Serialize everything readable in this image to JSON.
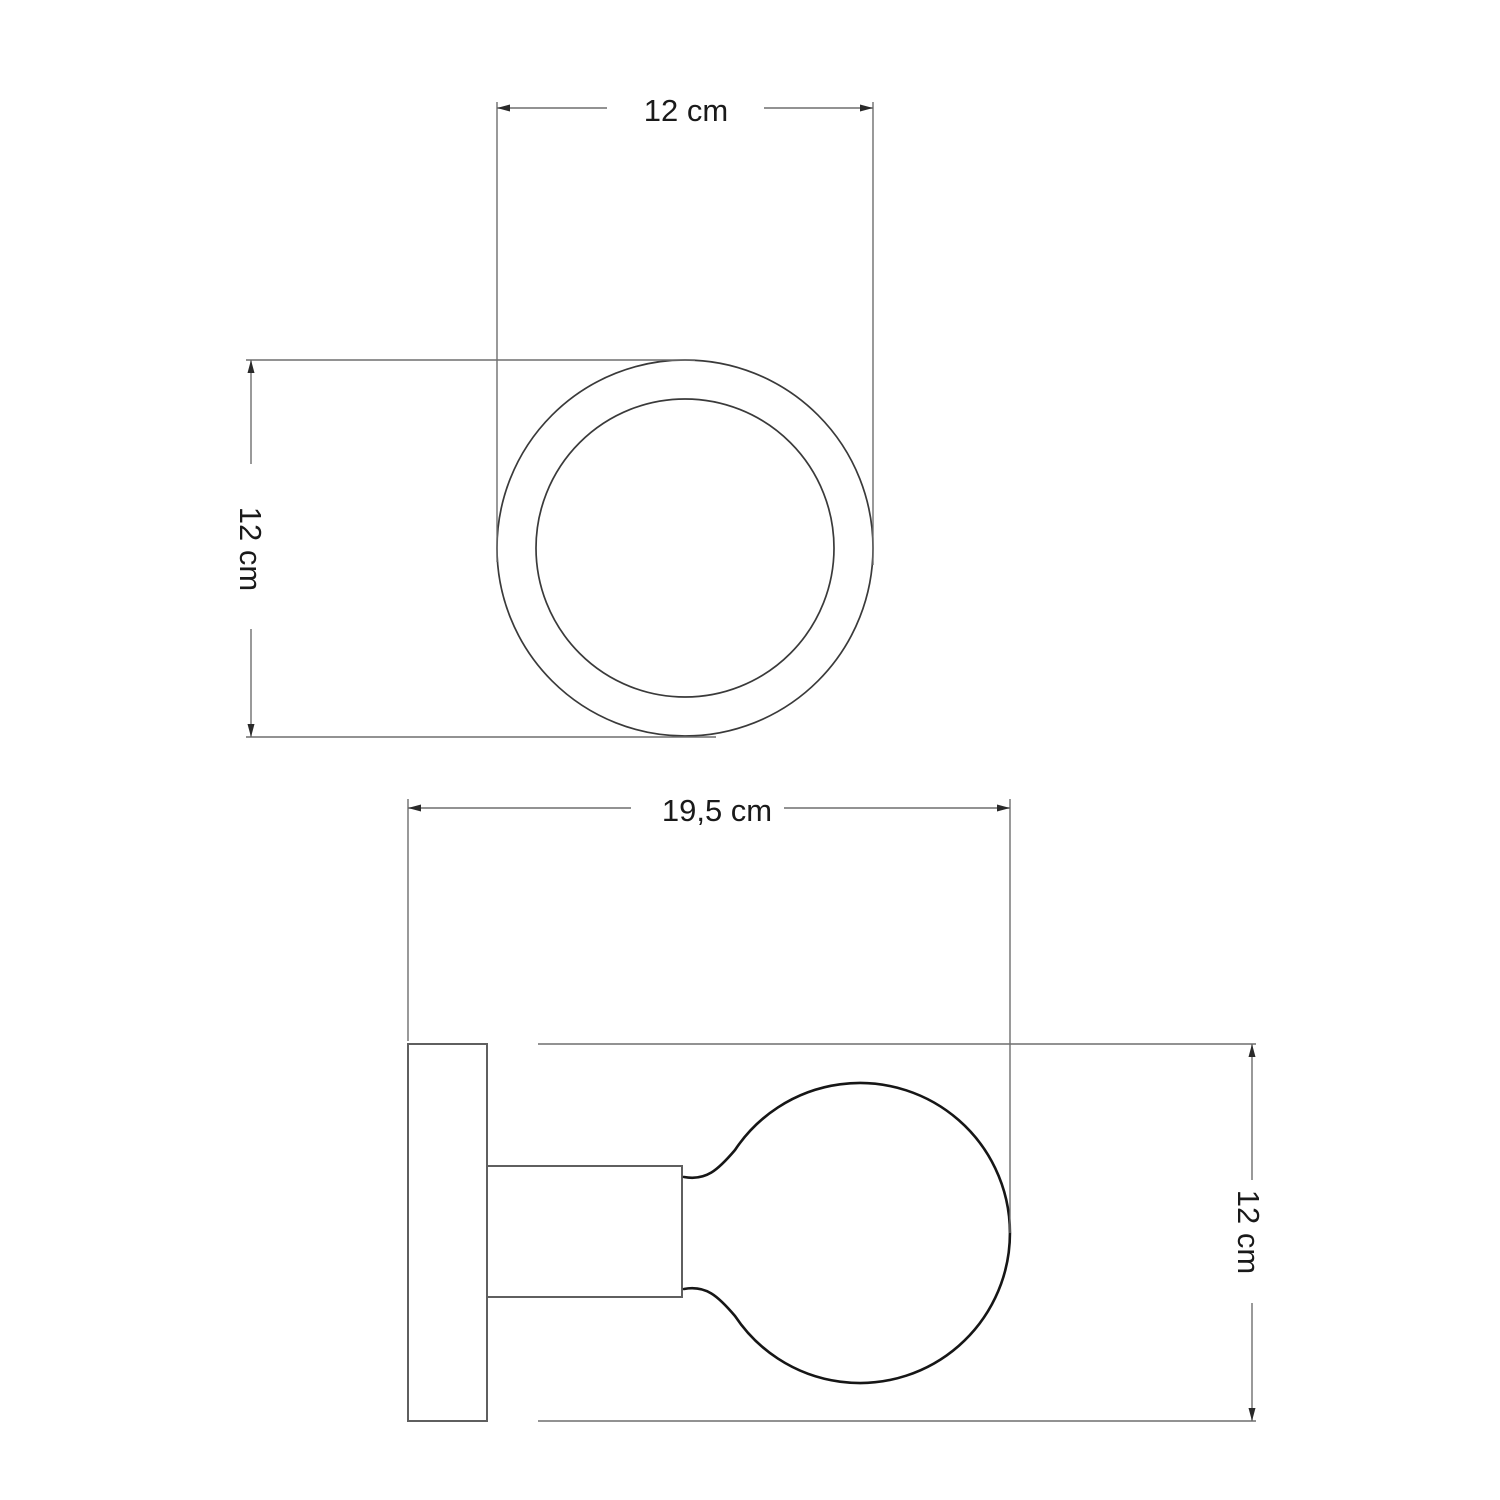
{
  "drawing": {
    "type": "technical-dimension-drawing",
    "subject": "wall lamp with round backplate, lamp holder and globe bulb",
    "unit": "cm",
    "views": {
      "top": {
        "name": "front view (round plate)",
        "width_dim": "12 cm",
        "height_dim": "12 cm",
        "width_value": 12,
        "height_value": 12
      },
      "side": {
        "name": "side view (plate, holder, bulb)",
        "width_dim": "19,5 cm",
        "height_dim": "12 cm",
        "width_value": 19.5,
        "height_value": 12
      }
    },
    "colors": {
      "background": "#ffffff",
      "dimension_line": "#6e6e6e",
      "shape_line": "#5f5f5f",
      "ring_line": "#3a3a3a",
      "bulb_line": "#161616",
      "text": "#1a1a1a"
    }
  }
}
